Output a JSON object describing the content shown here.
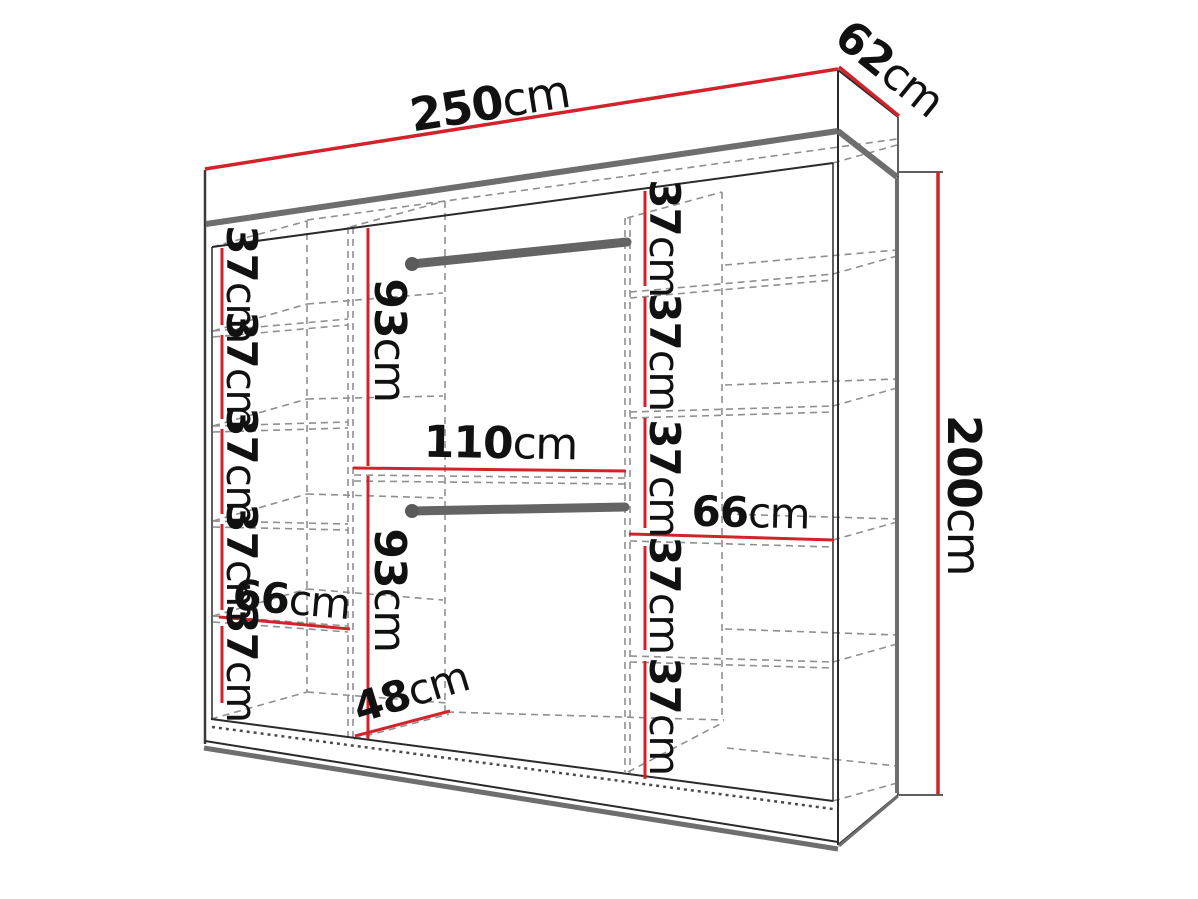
{
  "diagram": {
    "type": "wardrobe-dimension-diagram",
    "colors": {
      "dimension_red": "#d2232a",
      "outline_black": "#2a2a2a",
      "panel_gray": "#6e6e6e",
      "hidden_edge_gray": "#8f8f8f",
      "rod_gray": "#646464",
      "background": "#ffffff"
    },
    "overall": {
      "width": "250cm",
      "depth": "62cm",
      "height": "200cm"
    },
    "left_column": {
      "width": "66cm",
      "shelf_heights": [
        "37cm",
        "37cm",
        "37cm",
        "37cm",
        "37cm"
      ]
    },
    "middle_section": {
      "width": "110cm",
      "depth": "48cm",
      "upper_hanging_height": "93cm",
      "lower_hanging_height": "93cm"
    },
    "right_column": {
      "width": "66cm",
      "shelf_heights": [
        "37cm",
        "37cm",
        "37cm",
        "37cm",
        "37cm"
      ]
    }
  }
}
